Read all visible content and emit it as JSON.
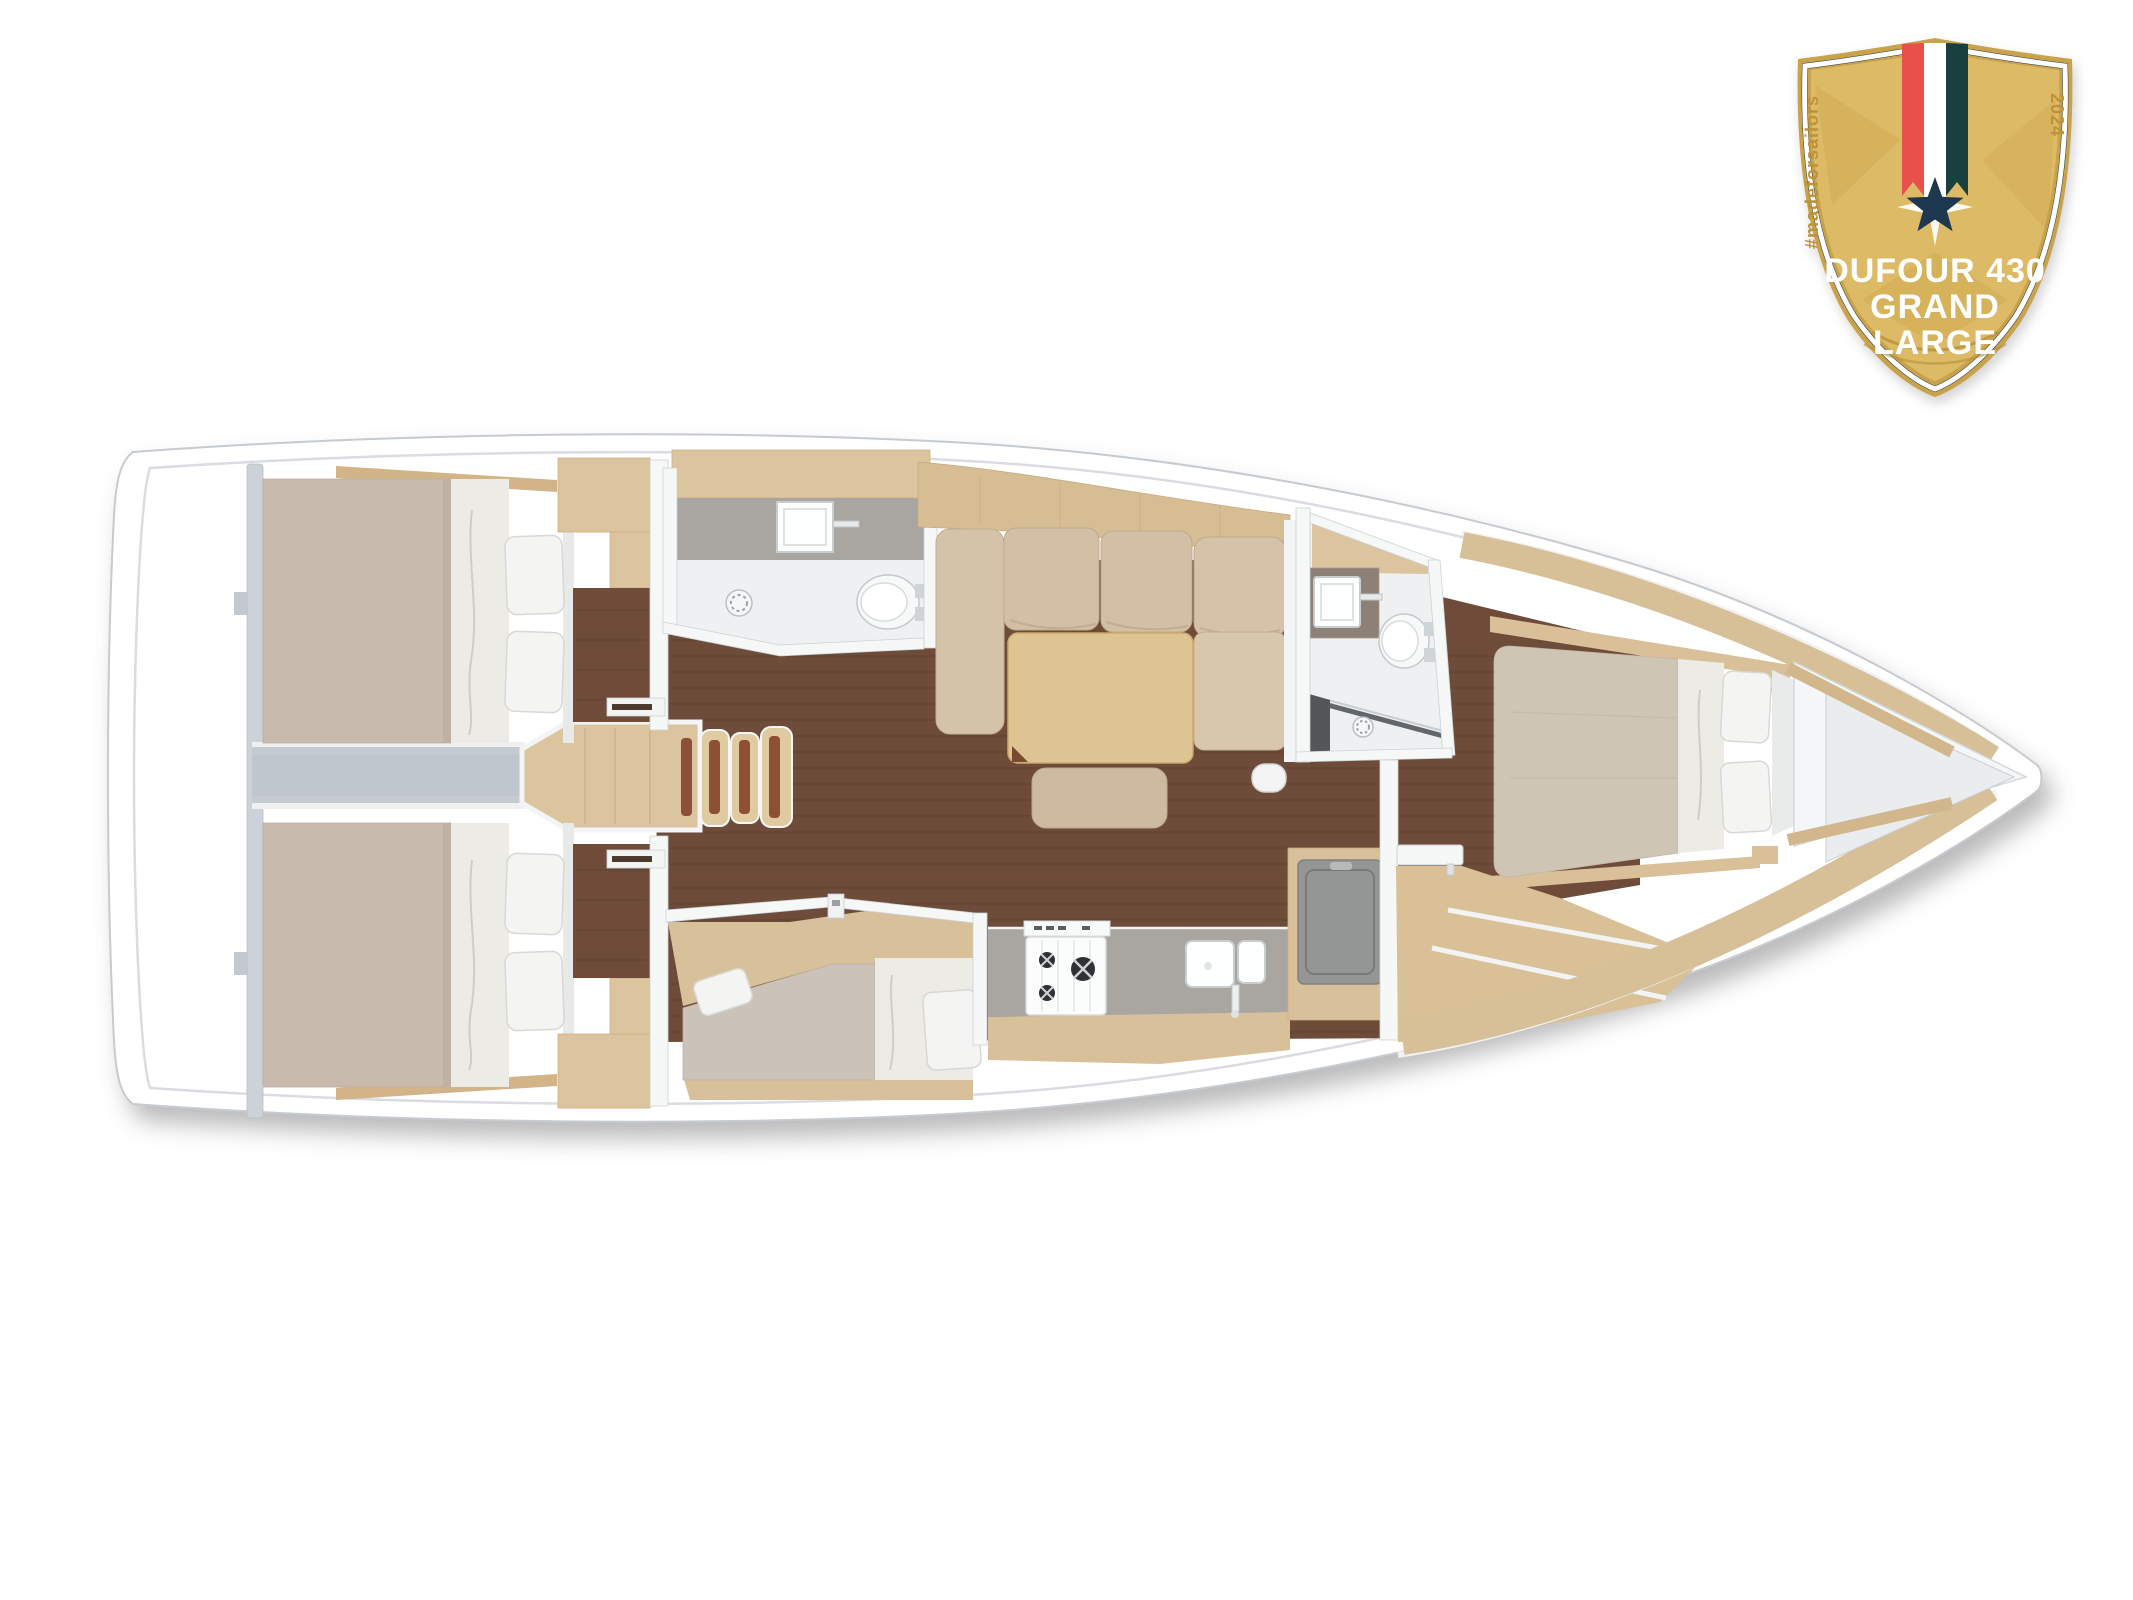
{
  "page": {
    "background": "#ffffff"
  },
  "badge": {
    "hashtag": "#madeforsailors",
    "year": "2024",
    "title_line1": "DUFOUR 430",
    "title_line2": "GRAND",
    "title_line3": "LARGE"
  },
  "colors": {
    "badge_gold": "#ddba65",
    "badge_gold_dark": "#c9a24a",
    "badge_gold_text": "#bd9238",
    "badge_navy": "#1e3850",
    "badge_red": "#e8504b",
    "badge_teal": "#17403e",
    "badge_white": "#ffffff",
    "hull_white": "#ffffff",
    "hull_outline": "#c6cbd0",
    "deck_line": "#d9dde1",
    "floor_brown": "#6e4c39",
    "wood_light": "#dcc49e",
    "wood_shelf": "#d6bd94",
    "wood_band": "#d7bf97",
    "mattress": "#c8baad",
    "mattress_fwd": "#cfc5b4",
    "sheet_white": "#edebe6",
    "pillow_white": "#f4f4f3",
    "cushion_beige": "#d2bfa5",
    "table_wood": "#dfc493",
    "counter_gray": "#a9a5a0",
    "counter_dark": "#8d8177",
    "bath_floor": "#eef0f1",
    "wall_white": "#f6f8f8",
    "corridor_gray": "#c5cbd1",
    "ladder_stripe": "#8d4f35",
    "fridge_gray": "#939695"
  }
}
